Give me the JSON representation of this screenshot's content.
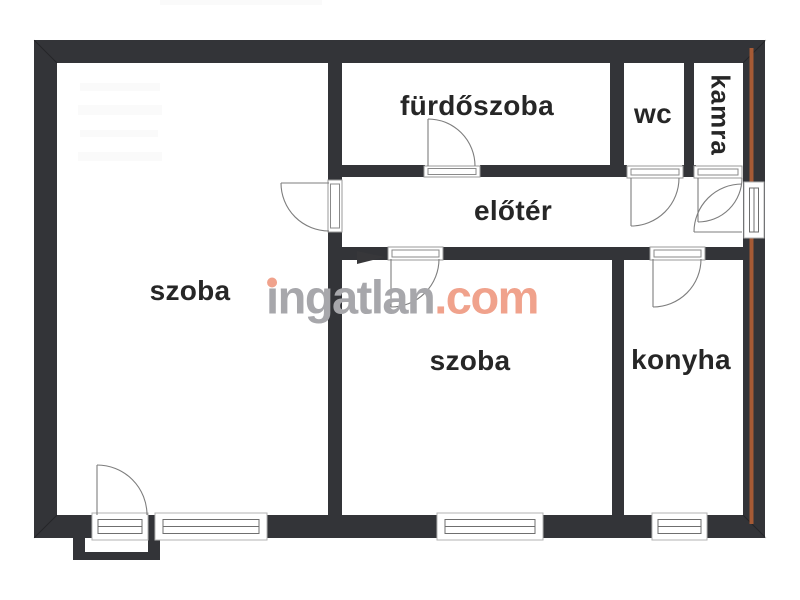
{
  "floorplan": {
    "rooms": {
      "szoba1": {
        "label": "szoba"
      },
      "furdoszoba": {
        "label": "fürdőszoba"
      },
      "wc": {
        "label": "wc"
      },
      "kamra": {
        "label": "kamra"
      },
      "eloter": {
        "label": "előtér"
      },
      "szoba2": {
        "label": "szoba"
      },
      "konyha": {
        "label": "konyha"
      }
    },
    "watermark": {
      "brand_head": "ı",
      "brand_rest": "ngatlan",
      "brand_tld": ".com"
    },
    "colors": {
      "wall": "#333438",
      "accent_line": "#a65a35",
      "watermark_gray": "#a7a7ab",
      "watermark_accent": "#f0a28c"
    }
  }
}
